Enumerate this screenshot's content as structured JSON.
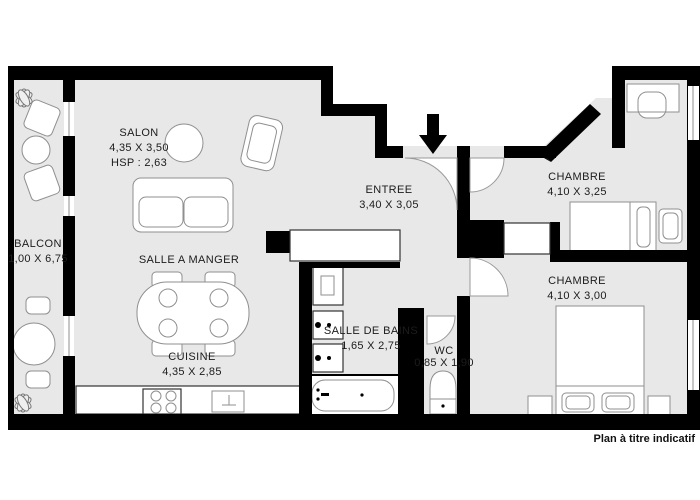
{
  "plan": {
    "disclaimer": "Plan à titre indicatif",
    "rooms": {
      "salon": {
        "name": "SALON",
        "dims": "4,35 X 3,50",
        "height_note": "HSP : 2,63"
      },
      "balcon": {
        "name": "BALCON",
        "dims": "1,00 X 6,75"
      },
      "salle_a_manger": {
        "name": "SALLE A MANGER"
      },
      "cuisine": {
        "name": "CUISINE",
        "dims": "4,35 X 2,85"
      },
      "entree": {
        "name": "ENTREE",
        "dims": "3,40 X 3,05"
      },
      "chambre_haut": {
        "name": "CHAMBRE",
        "dims": "4,10 X 3,25"
      },
      "chambre_bas": {
        "name": "CHAMBRE",
        "dims": "4,10 X 3,00"
      },
      "salle_de_bains": {
        "name": "SALLE DE BAINS",
        "dims": "1,65 X 2,75"
      },
      "wc": {
        "name": "WC",
        "dims": "0,85 X 1,90"
      }
    },
    "icons": {
      "entrance_arrow": "down-arrow-entrance",
      "furniture": [
        "sofa",
        "armchair",
        "coffee-table",
        "balcony-chairs",
        "balcony-table",
        "plants",
        "dining-table-4-seats",
        "kitchen-counter",
        "stove",
        "kitchen-sink",
        "washing-machine",
        "bathroom-sinks",
        "bathtub",
        "toilet",
        "desk-with-chair",
        "single-bed",
        "double-bed",
        "nightstands",
        "closets"
      ]
    },
    "colors": {
      "wall": "#000000",
      "floor": "#e8e8e8",
      "furniture_stroke": "#8f8f8f",
      "background": "#ffffff"
    }
  }
}
